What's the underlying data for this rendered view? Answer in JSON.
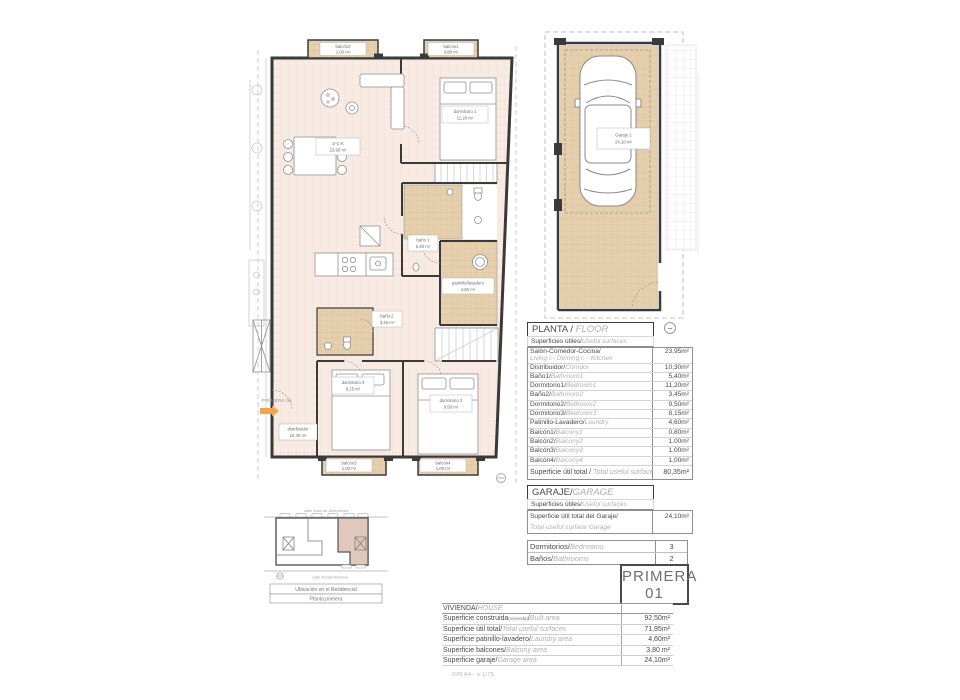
{
  "plan": {
    "entry_label": "PRIMERA 01",
    "rooms": {
      "sck": {
        "name": "S-C-K",
        "area": "23,95 m²"
      },
      "dorm1": {
        "name": "dormitorio 1",
        "area": "11,20 m²"
      },
      "bano1": {
        "name": "baño 1",
        "area": "5,40 m²"
      },
      "patinillo": {
        "name": "patinillo/lavadero",
        "area": "4,60 m²"
      },
      "bano2": {
        "name": "baño 2",
        "area": "3,45 m²"
      },
      "dorm3": {
        "name": "dormitorio 3",
        "area": "8,15 m²"
      },
      "dorm2": {
        "name": "dormitorio 2",
        "area": "9,50 m²"
      },
      "distribuidor": {
        "name": "distribuidor",
        "area": "10,30 m²"
      },
      "balcon1": {
        "name": "balcón1",
        "area": "0,80 m²"
      },
      "balcon2": {
        "name": "balcón2",
        "area": "1,00 m²"
      },
      "balcon3": {
        "name": "balcón3",
        "area": "1,00 m²"
      },
      "balcon4": {
        "name": "balcón4",
        "area": "1,00 m²"
      }
    }
  },
  "garage_plan": {
    "name": "Garaje 1",
    "area": "24,10 m²"
  },
  "planta": {
    "header_es": "PLANTA / ",
    "header_en": "FLOOR",
    "sub_es": "Superficies útiles/",
    "sub_en": "Useful surfaces",
    "rows": [
      {
        "es": "Salón-Comedor-Cocina/",
        "en": "Living r.- Dinning r. - Kitchen",
        "value": "23,95m²"
      },
      {
        "es": "Distribuidor/",
        "en": "Corridor",
        "value": "10,30m²"
      },
      {
        "es": "Baño1/",
        "en": "Bathroom1",
        "value": "5,40m²"
      },
      {
        "es": "Dormitorio1/",
        "en": "Bedroom1",
        "value": "11,20m²"
      },
      {
        "es": "Baño2/",
        "en": "Bathroom2",
        "value": "3,45m²"
      },
      {
        "es": "Dormitorio2/",
        "en": "Bedroom2",
        "value": "9,50m²"
      },
      {
        "es": "Dormitorio3/",
        "en": "Bedroom3",
        "value": "8,15m²"
      },
      {
        "es": "Patinillo-Lavadero/",
        "en": "Laundry",
        "value": "4,60m²"
      },
      {
        "es": "Balcón1/",
        "en": "Balcony1",
        "value": "0,80m²"
      },
      {
        "es": "Balcón2/",
        "en": "Balcony2",
        "value": "1,00m²"
      },
      {
        "es": "Balcón3/",
        "en": "Balcony3",
        "value": "1,00m²"
      },
      {
        "es": "Balcón4/",
        "en": "Balcony4",
        "value": "1,00m²"
      }
    ],
    "total": {
      "es": "Superficie útil total / ",
      "en": "Total useful surface",
      "value": "80,35m²"
    }
  },
  "garaje": {
    "header_es": "GARAJE/",
    "header_en": "GARAGE",
    "sub_es": "Superficies útiles/",
    "sub_en": "Useful surfaces",
    "row": {
      "es": "Superficie útil total del Garaje/",
      "en": "Total useful surface Garage",
      "value": "24,10m²"
    }
  },
  "counts": {
    "rows": [
      {
        "es": "Dormitorios/",
        "en": "Bedrooms",
        "value": "3"
      },
      {
        "es": "Baños/",
        "en": "Bathrooms",
        "value": "2"
      }
    ]
  },
  "badge": {
    "line1": "PRIMERA",
    "line2": "01"
  },
  "vivienda": {
    "header_es": "VIVIENDA/",
    "header_en": "HOUSE",
    "rows": [
      {
        "es": "Superficie construida",
        "sub": "(vivienda)",
        "slash": "/",
        "en": "Built area",
        "value": "92,50m²"
      },
      {
        "es": "Superficie útil total/",
        "sub": "",
        "slash": "",
        "en": "Total useful surfaces",
        "value": "71,95m²"
      },
      {
        "es": "Superficie patinillo-lavadero/",
        "sub": "",
        "slash": "",
        "en": "Laundry area",
        "value": "4,60m²"
      },
      {
        "es": "Superficie balcones/",
        "sub": "",
        "slash": "",
        "en": "Balcony area",
        "value": "3,80 m²"
      },
      {
        "es": "Superficie garaje/",
        "sub": "",
        "slash": "",
        "en": "Garage area",
        "value": "24,10m²"
      }
    ]
  },
  "map": {
    "street_top": "calle Juan de Alhendines",
    "street_bottom": "calle Tomás Bordoni",
    "caption1": "Ubicación en el Residencial",
    "caption2": "Planta primera"
  },
  "footer": {
    "note": "DIN A4 - e 1/75"
  },
  "colors": {
    "accent_arrow": "#efa54d",
    "room_fill": "#f8ebe3",
    "tile_fill": "#e5cfad",
    "highlight_unit": "#e0c9bc"
  }
}
